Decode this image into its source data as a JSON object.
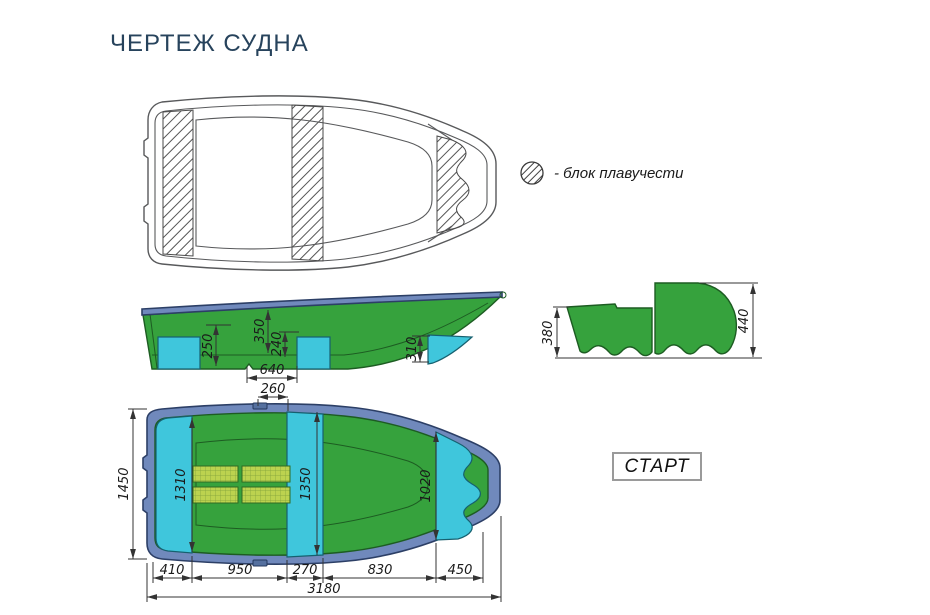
{
  "title": "ЧЕРТЕЖ СУДНА",
  "legend": {
    "label": "- блок плавучести"
  },
  "model": {
    "label": "СТАРТ"
  },
  "colors": {
    "title_blue": "#27435c",
    "hull_green": "#36a23d",
    "hull_green_dark": "#1d5c22",
    "gunwale_blue": "#7089bc",
    "gunwale_blue_dark": "#2c3f66",
    "seat_cyan": "#3fc6dc",
    "seat_cyan_dark": "#16606f",
    "floor_panel": "#bcd24f",
    "floor_panel_grid": "#7fa03a",
    "line_dark": "#333333"
  },
  "dims": {
    "side": {
      "seat_height": "250",
      "depth": "350",
      "thwart_height": "240",
      "block_spacing": "640",
      "bow_block_height": "310"
    },
    "section": {
      "left_depth": "380",
      "right_depth": "440"
    },
    "plan": {
      "top_offset": "260",
      "beam": "1450",
      "stern_seat": "1310",
      "midship": "1350",
      "bow_opening": "1020",
      "lengths": [
        "410",
        "950",
        "270",
        "830",
        "450"
      ],
      "overall_length": "3180"
    }
  }
}
